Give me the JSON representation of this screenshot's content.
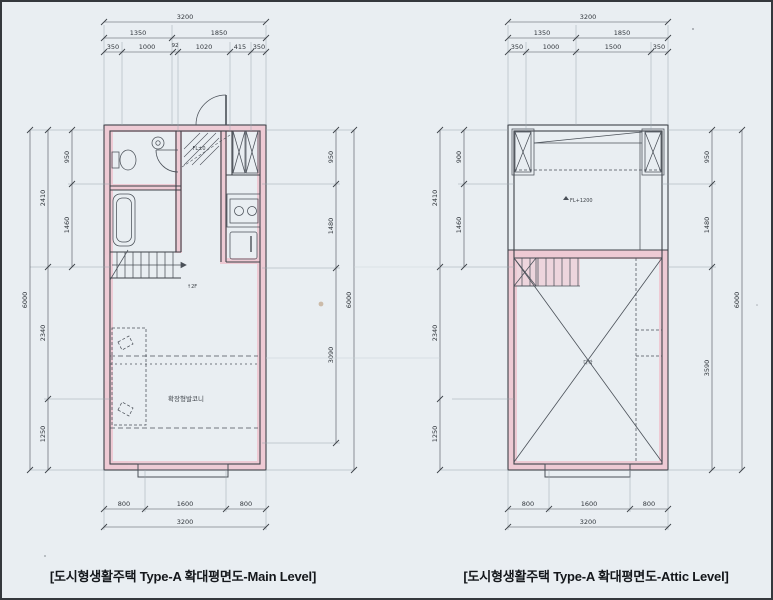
{
  "page": {
    "captions": {
      "main": "[도시형생활주택 Type-A 확대평면도-Main Level]",
      "attic": "[도시형생활주택 Type-A 확대평면도-Attic Level]"
    }
  },
  "colors": {
    "paper": "#e9eef2",
    "wall_line": "#3d4248",
    "dim_line": "#4a5057",
    "extension_line": "#9aa6ae",
    "highlight_pink": "#f3a8b8",
    "caption_text": "#14171b"
  },
  "main_plan": {
    "name": "Main Level",
    "dims": {
      "top_total": "3200",
      "top_row2": [
        "1350",
        "1850"
      ],
      "top_row3": [
        "350",
        "1000",
        "92",
        "1020",
        "415",
        "350"
      ],
      "left_outer": "6000",
      "left_mid": [
        "2410",
        "2340",
        "1250"
      ],
      "left_inner": [
        "950",
        "1460"
      ],
      "right_inner": [
        "950",
        "1480",
        "3090"
      ],
      "right_outer": "6000",
      "bottom_row": [
        "800",
        "1600",
        "800"
      ],
      "bottom_total": "3200"
    },
    "labels": {
      "balcony": "확장형발코니",
      "stairs_up": "↑2F",
      "entry_level": "FL±0"
    }
  },
  "attic_plan": {
    "name": "Attic Level",
    "dims": {
      "top_total": "3200",
      "top_row2": [
        "1350",
        "1850"
      ],
      "top_row3": [
        "350",
        "1000",
        "1500",
        "350"
      ],
      "left_mid": [
        "2410",
        "2340",
        "1250"
      ],
      "left_inner": [
        "900",
        "1460"
      ],
      "right_inner": [
        "950",
        "1480",
        "3590"
      ],
      "right_outer": "6000",
      "bottom_row": [
        "800",
        "1600",
        "800"
      ],
      "bottom_total": "3200"
    },
    "labels": {
      "void_level": "FL+1200",
      "attic_room": "다락"
    }
  }
}
